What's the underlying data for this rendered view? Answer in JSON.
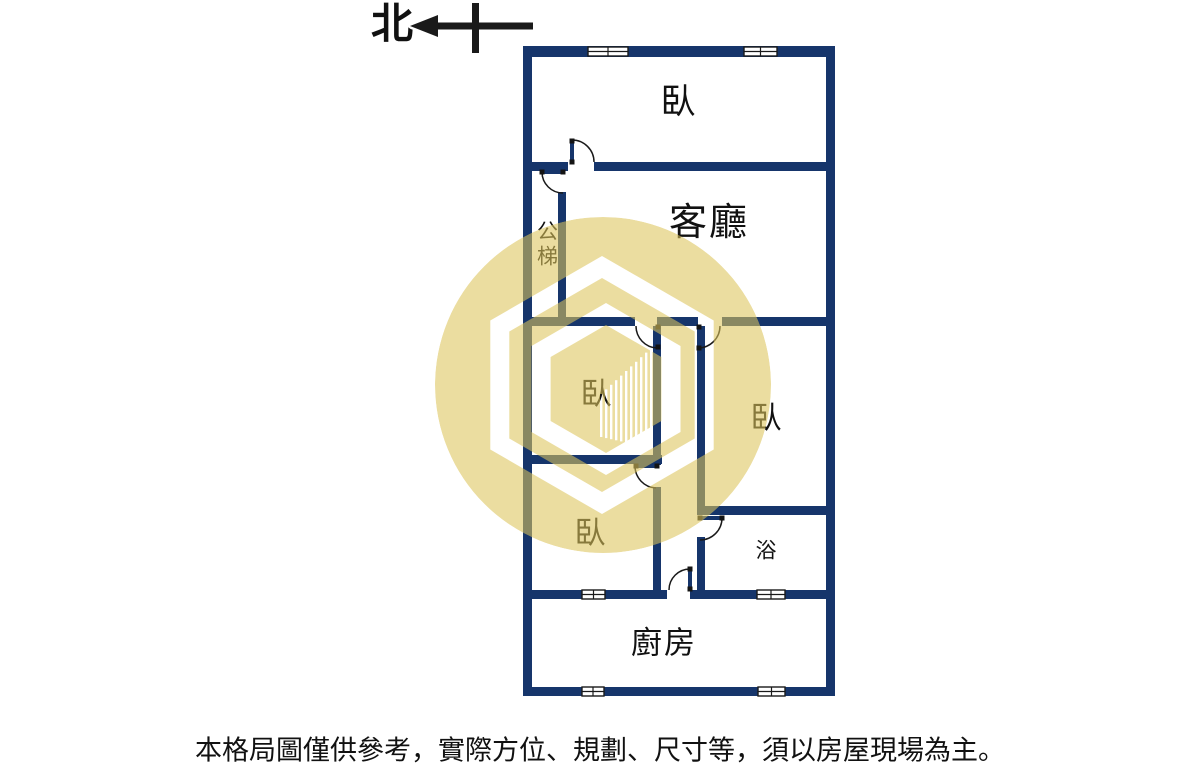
{
  "compass": {
    "label": "北"
  },
  "rooms": {
    "bedroom_top": {
      "label": "臥"
    },
    "living_room": {
      "label": "客廳"
    },
    "public_stairs": {
      "label": "公梯"
    },
    "bedroom_mid": {
      "label": "臥"
    },
    "bedroom_right": {
      "label": "臥"
    },
    "bedroom_lower": {
      "label": "臥"
    },
    "bathroom": {
      "label": "浴"
    },
    "kitchen": {
      "label": "廚房"
    }
  },
  "footer": {
    "disclaimer": "本格局圖僅供參考，實際方位、規劃、尺寸等，須以房屋現場為主。"
  },
  "colors": {
    "wall": "#16356b",
    "ink": "#1a1a1a",
    "label": "#111111",
    "wm": "#dcc45c"
  }
}
